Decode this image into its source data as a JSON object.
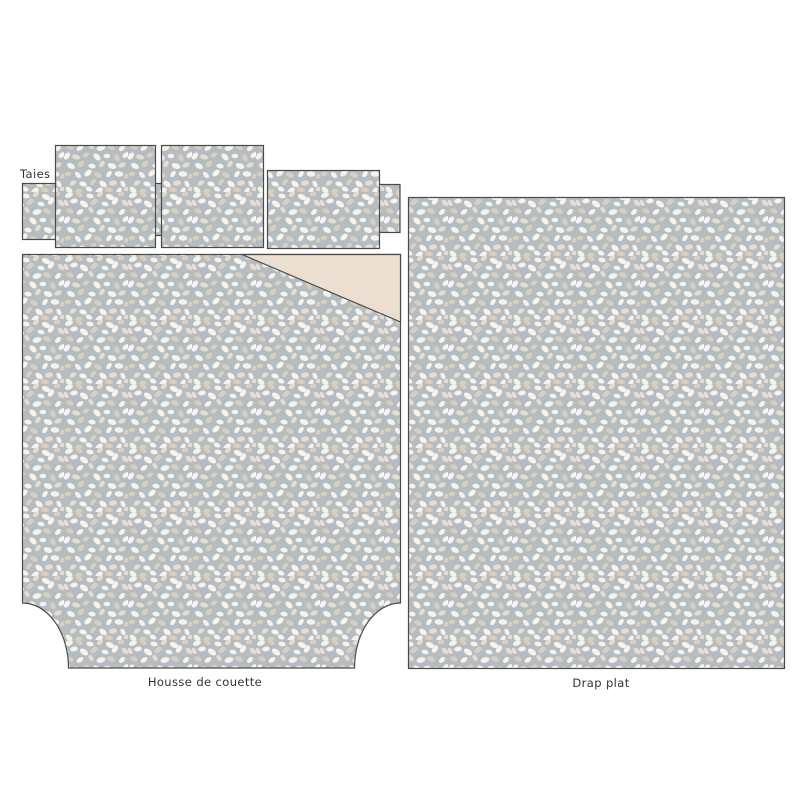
{
  "diagram": {
    "title": "bedding-set-flat-lay",
    "labels": {
      "pillowcases": "Taies",
      "duvet_cover": "Housse de couette",
      "flat_sheet": "Drap plat"
    },
    "colors": {
      "canvas_bg": "#ffffff",
      "fabric_base": "#b5bcc2",
      "petal_white": "#f6f3ed",
      "petal_beige": "#dbcebc",
      "petal_cream": "#e8ddcc",
      "fold_backing": "#ecdfd1",
      "outline": "#4a4a4a",
      "label_text": "#333333"
    }
  }
}
